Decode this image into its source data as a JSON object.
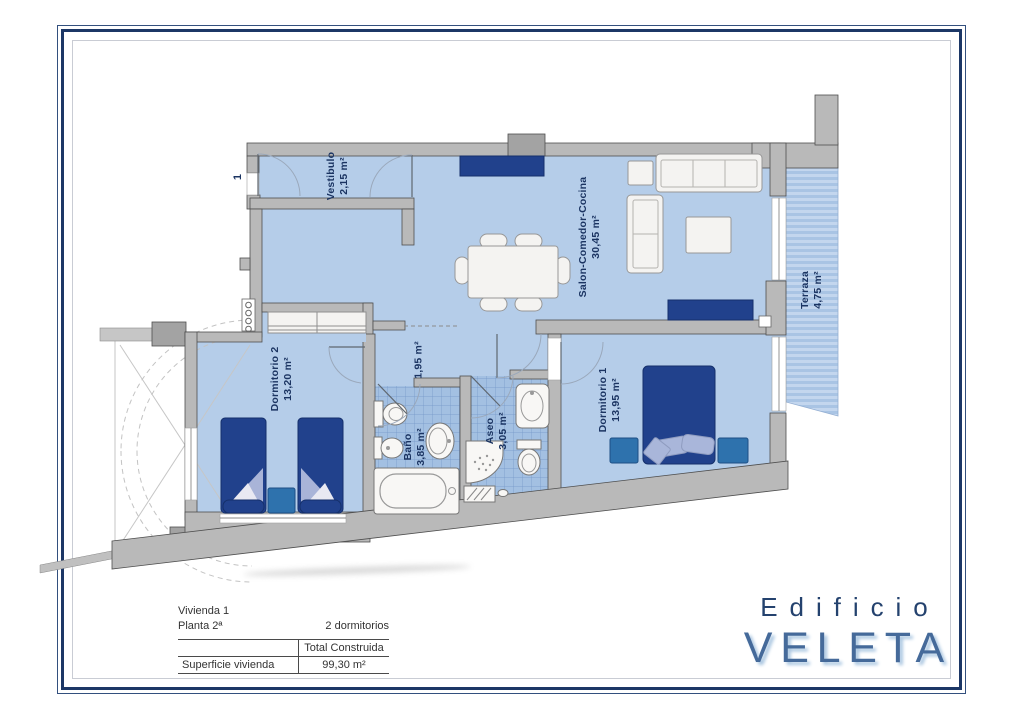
{
  "sheet": {
    "unit_label": "1"
  },
  "rooms": {
    "vestibulo": {
      "name": "Vestibulo",
      "area": "2,15 m²"
    },
    "salon": {
      "name": "Salon-Comedor-Cocina",
      "area": "30,45 m²"
    },
    "terraza": {
      "name": "Terraza",
      "area": "4,75 m²"
    },
    "pasillo": {
      "area": "1,95 m²"
    },
    "bano": {
      "name": "Baño",
      "area": "3,85 m²"
    },
    "aseo": {
      "name": "Aseo",
      "area": "3,05 m²"
    },
    "dormitorio1": {
      "name": "Dormitorio 1",
      "area": "13,95 m²"
    },
    "dormitorio2": {
      "name": "Dormitorio 2",
      "area": "13,20 m²"
    }
  },
  "info": {
    "vivienda": "Vivienda 1",
    "planta": "Planta 2ª",
    "dormitorios": "2 dormitorios",
    "col_header": "Total Construida",
    "row_label": "Superficie vivienda",
    "row_value": "99,30 m²"
  },
  "logo": {
    "line1": "Edificio",
    "line2": "VELETA"
  },
  "colors": {
    "navy": "#1c3766",
    "floor": "#b5cde9",
    "wall": "#b9b9b9",
    "wall_edge": "#4e4e4e",
    "furniture_dark": "#21418c",
    "furniture_mid": "#2e72ad",
    "tile": "#a3c0e2",
    "stripe_light": "#c3d6ee",
    "stripe_dark": "#a9c4e4",
    "label": "#1b3462",
    "logo_fill": "#456a9a",
    "logo_shadow": "#a8c5e0",
    "text": "#333333"
  }
}
